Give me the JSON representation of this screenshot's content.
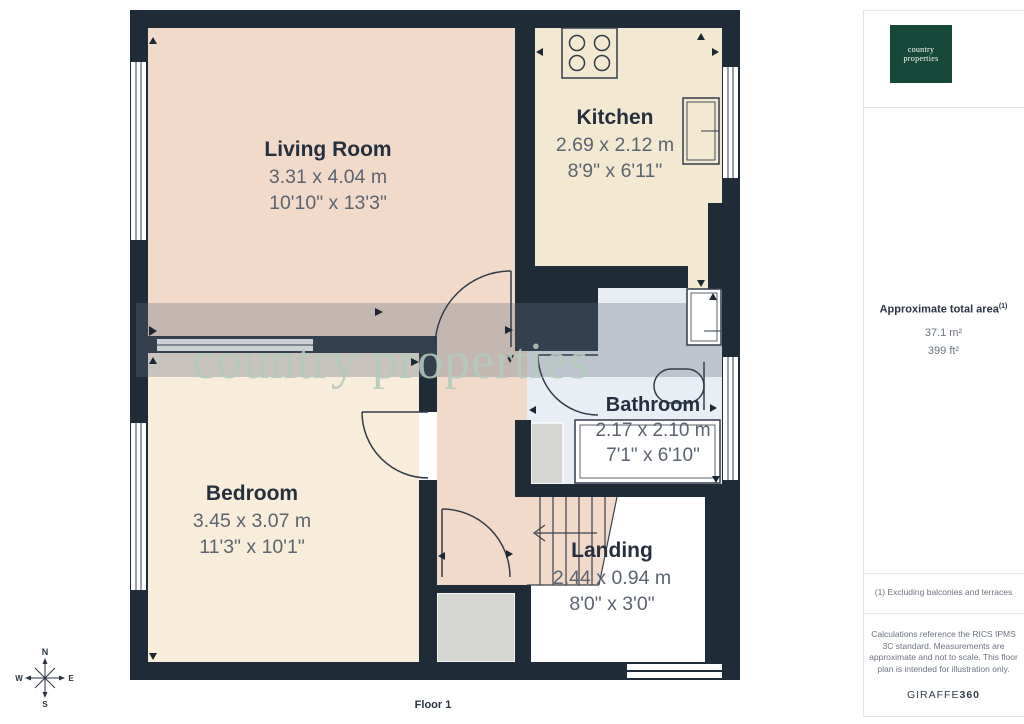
{
  "page": {
    "floor_label": "Floor 1"
  },
  "watermark": {
    "text": "country properties"
  },
  "rooms": [
    {
      "name": "Living Room",
      "metric": "3.31 x 4.04 m",
      "imperial": "10'10\" x 13'3\""
    },
    {
      "name": "Kitchen",
      "metric": "2.69 x 2.12 m",
      "imperial": "8'9\" x 6'11\""
    },
    {
      "name": "Bathroom",
      "metric": "2.17 x 2.10 m",
      "imperial": "7'1\" x 6'10\""
    },
    {
      "name": "Bedroom",
      "metric": "3.45 x 3.07 m",
      "imperial": "11'3\" x 10'1\""
    },
    {
      "name": "Landing",
      "metric": "2.44 x 0.94 m",
      "imperial": "8'0\" x 3'0\""
    }
  ],
  "compass": {
    "north": "N",
    "east": "E",
    "south": "S",
    "west": "W"
  },
  "sidebar": {
    "logo_line1": "country",
    "logo_line2": "properties",
    "area_title": "Approximate total area",
    "area_note_ref": "(1)",
    "area_metric": "37.1 m²",
    "area_imperial": "399 ft²",
    "footnote": "(1) Excluding balconies and terraces",
    "disclaimer": "Calculations reference the RICS IPMS 3C standard. Measurements are approximate and not to scale. This floor plan is intended for illustration only.",
    "brand_name": "GIRAFFE",
    "brand_number": "360"
  },
  "colors": {
    "wall": "#202b38",
    "living_room": "#f2dacb",
    "kitchen": "#f3e9d2",
    "bedroom": "#f8ecda",
    "bathroom": "#e9eef4",
    "cupboard": "#d5d5d1",
    "logo_green": "#17493a",
    "watermark_green": "#b4c8bc"
  }
}
